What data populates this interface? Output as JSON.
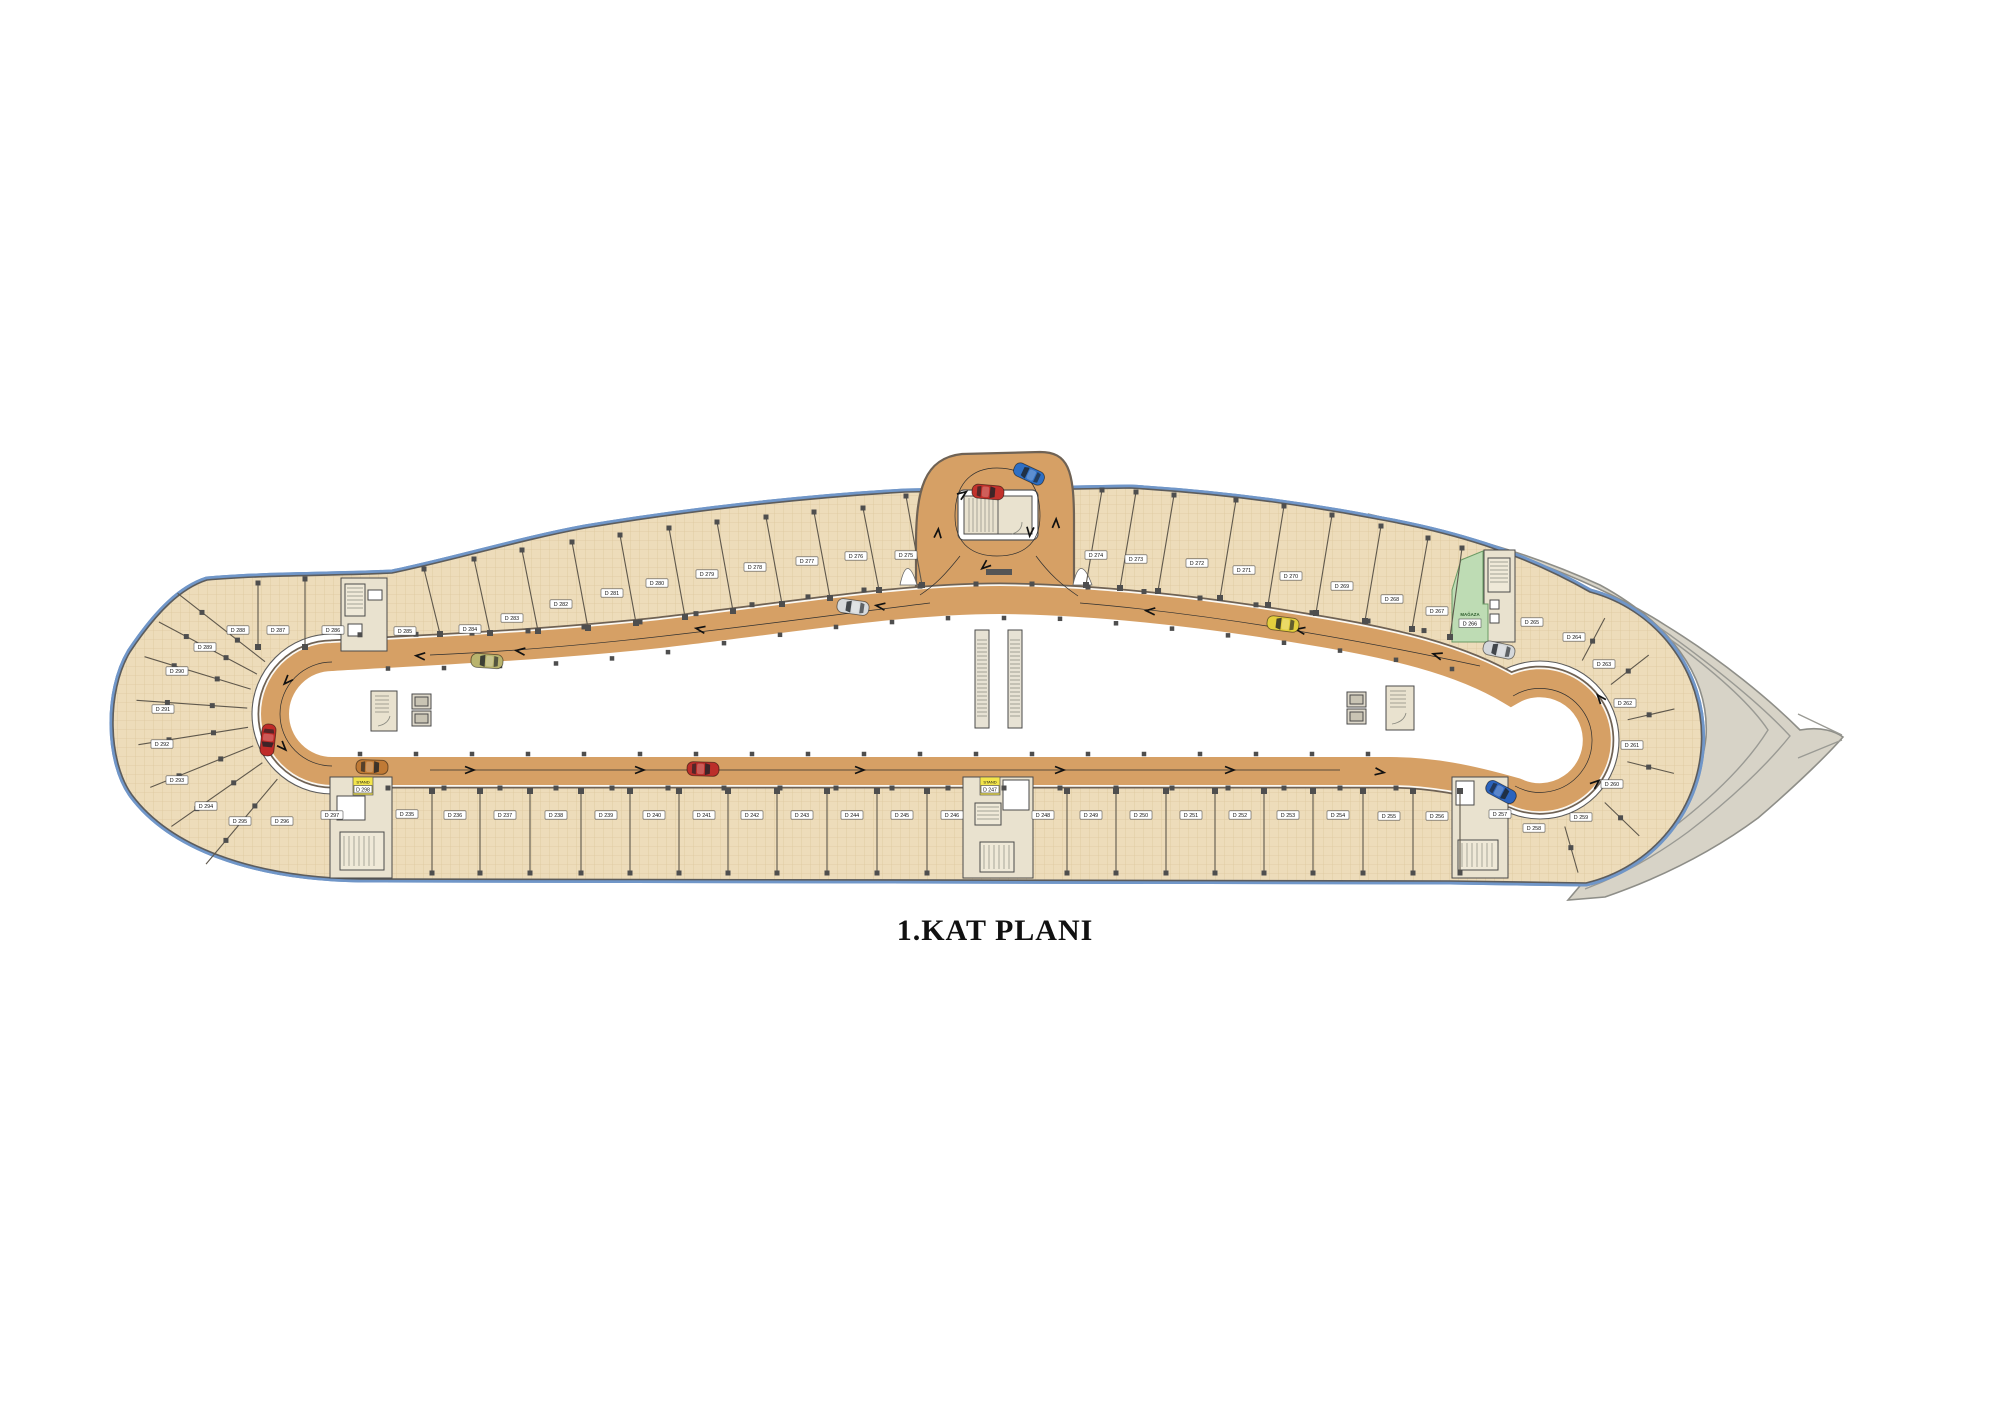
{
  "title": "1.KAT PLANI",
  "colors": {
    "parking_floor": "#eddcba",
    "roadway": "#d6a065",
    "road_edge": "#6f6254",
    "ramp_shell": "#d7d3c7",
    "stand_highlight": "#f3e54b",
    "shop_green": "#bedcb4",
    "boundary_blue": "#7096c8"
  },
  "unit_labels": [
    {
      "label": "D 288",
      "x": 238,
      "y": 630
    },
    {
      "label": "D 287",
      "x": 278,
      "y": 630
    },
    {
      "label": "D 286",
      "x": 333,
      "y": 630
    },
    {
      "label": "D 285",
      "x": 405,
      "y": 631
    },
    {
      "label": "D 284",
      "x": 470,
      "y": 629
    },
    {
      "label": "D 283",
      "x": 512,
      "y": 618
    },
    {
      "label": "D 282",
      "x": 561,
      "y": 604
    },
    {
      "label": "D 281",
      "x": 612,
      "y": 593
    },
    {
      "label": "D 280",
      "x": 657,
      "y": 583
    },
    {
      "label": "D 279",
      "x": 707,
      "y": 574
    },
    {
      "label": "D 278",
      "x": 755,
      "y": 567
    },
    {
      "label": "D 277",
      "x": 807,
      "y": 561
    },
    {
      "label": "D 276",
      "x": 856,
      "y": 556
    },
    {
      "label": "D 275",
      "x": 906,
      "y": 555
    },
    {
      "label": "D 274",
      "x": 1096,
      "y": 555
    },
    {
      "label": "D 273",
      "x": 1136,
      "y": 559
    },
    {
      "label": "D 272",
      "x": 1197,
      "y": 563
    },
    {
      "label": "D 271",
      "x": 1244,
      "y": 570
    },
    {
      "label": "D 270",
      "x": 1291,
      "y": 576
    },
    {
      "label": "D 269",
      "x": 1342,
      "y": 586
    },
    {
      "label": "D 268",
      "x": 1392,
      "y": 599
    },
    {
      "label": "D 267",
      "x": 1437,
      "y": 611
    },
    {
      "label": "D 265",
      "x": 1532,
      "y": 622
    },
    {
      "label": "D 264",
      "x": 1574,
      "y": 637
    },
    {
      "label": "D 263",
      "x": 1604,
      "y": 664
    },
    {
      "label": "D 262",
      "x": 1625,
      "y": 703
    },
    {
      "label": "D 261",
      "x": 1632,
      "y": 745
    },
    {
      "label": "D 260",
      "x": 1612,
      "y": 784
    },
    {
      "label": "D 259",
      "x": 1581,
      "y": 817
    },
    {
      "label": "D 258",
      "x": 1534,
      "y": 828
    },
    {
      "label": "D 289",
      "x": 205,
      "y": 647
    },
    {
      "label": "D 290",
      "x": 177,
      "y": 671
    },
    {
      "label": "D 291",
      "x": 163,
      "y": 709
    },
    {
      "label": "D 292",
      "x": 162,
      "y": 744
    },
    {
      "label": "D 293",
      "x": 177,
      "y": 780
    },
    {
      "label": "D 294",
      "x": 206,
      "y": 806
    },
    {
      "label": "D 295",
      "x": 240,
      "y": 821
    },
    {
      "label": "D 296",
      "x": 282,
      "y": 821
    },
    {
      "label": "D 297",
      "x": 332,
      "y": 815
    },
    {
      "label": "D 235",
      "x": 407,
      "y": 814
    },
    {
      "label": "D 236",
      "x": 455,
      "y": 815
    },
    {
      "label": "D 237",
      "x": 505,
      "y": 815
    },
    {
      "label": "D 238",
      "x": 556,
      "y": 815
    },
    {
      "label": "D 239",
      "x": 606,
      "y": 815
    },
    {
      "label": "D 240",
      "x": 654,
      "y": 815
    },
    {
      "label": "D 241",
      "x": 704,
      "y": 815
    },
    {
      "label": "D 242",
      "x": 752,
      "y": 815
    },
    {
      "label": "D 243",
      "x": 802,
      "y": 815
    },
    {
      "label": "D 244",
      "x": 852,
      "y": 815
    },
    {
      "label": "D 245",
      "x": 902,
      "y": 815
    },
    {
      "label": "D 246",
      "x": 952,
      "y": 815
    },
    {
      "label": "D 248",
      "x": 1043,
      "y": 815
    },
    {
      "label": "D 249",
      "x": 1091,
      "y": 815
    },
    {
      "label": "D 250",
      "x": 1141,
      "y": 815
    },
    {
      "label": "D 251",
      "x": 1191,
      "y": 815
    },
    {
      "label": "D 252",
      "x": 1240,
      "y": 815
    },
    {
      "label": "D 253",
      "x": 1288,
      "y": 815
    },
    {
      "label": "D 254",
      "x": 1338,
      "y": 815
    },
    {
      "label": "D 255",
      "x": 1389,
      "y": 816
    },
    {
      "label": "D 256",
      "x": 1437,
      "y": 816
    },
    {
      "label": "D 257",
      "x": 1500,
      "y": 814
    }
  ],
  "stand_labels": [
    {
      "caption": "STAND",
      "label": "D 298",
      "x": 363,
      "y": 786
    },
    {
      "caption": "STAND",
      "label": "D 247",
      "x": 990,
      "y": 786
    }
  ],
  "shop": {
    "caption": "MAĞAZA",
    "label": "D 266",
    "x": 1470,
    "y": 616
  },
  "cars": [
    {
      "name": "red-car",
      "color": "#bf2b28",
      "x": 268,
      "y": 740,
      "rot": 96
    },
    {
      "name": "orange-car",
      "color": "#c07a35",
      "x": 372,
      "y": 767,
      "rot": 2
    },
    {
      "name": "khaki-car",
      "color": "#b9b46e",
      "x": 487,
      "y": 661,
      "rot": 184
    },
    {
      "name": "red-car",
      "color": "#bb2f2a",
      "x": 703,
      "y": 769,
      "rot": 2
    },
    {
      "name": "silver-car",
      "color": "#d7dadc",
      "x": 853,
      "y": 607,
      "rot": 188
    },
    {
      "name": "blue-car",
      "color": "#2f6fc3",
      "x": 1029,
      "y": 474,
      "rot": 205
    },
    {
      "name": "red-car",
      "color": "#c2322c",
      "x": 988,
      "y": 492,
      "rot": 5
    },
    {
      "name": "yellow-car",
      "color": "#e4cf3d",
      "x": 1283,
      "y": 624,
      "rot": 187
    },
    {
      "name": "silver-car",
      "color": "#d4d7da",
      "x": 1499,
      "y": 650,
      "rot": 192
    },
    {
      "name": "blue-car",
      "color": "#2b63bd",
      "x": 1501,
      "y": 792,
      "rot": 28
    }
  ]
}
